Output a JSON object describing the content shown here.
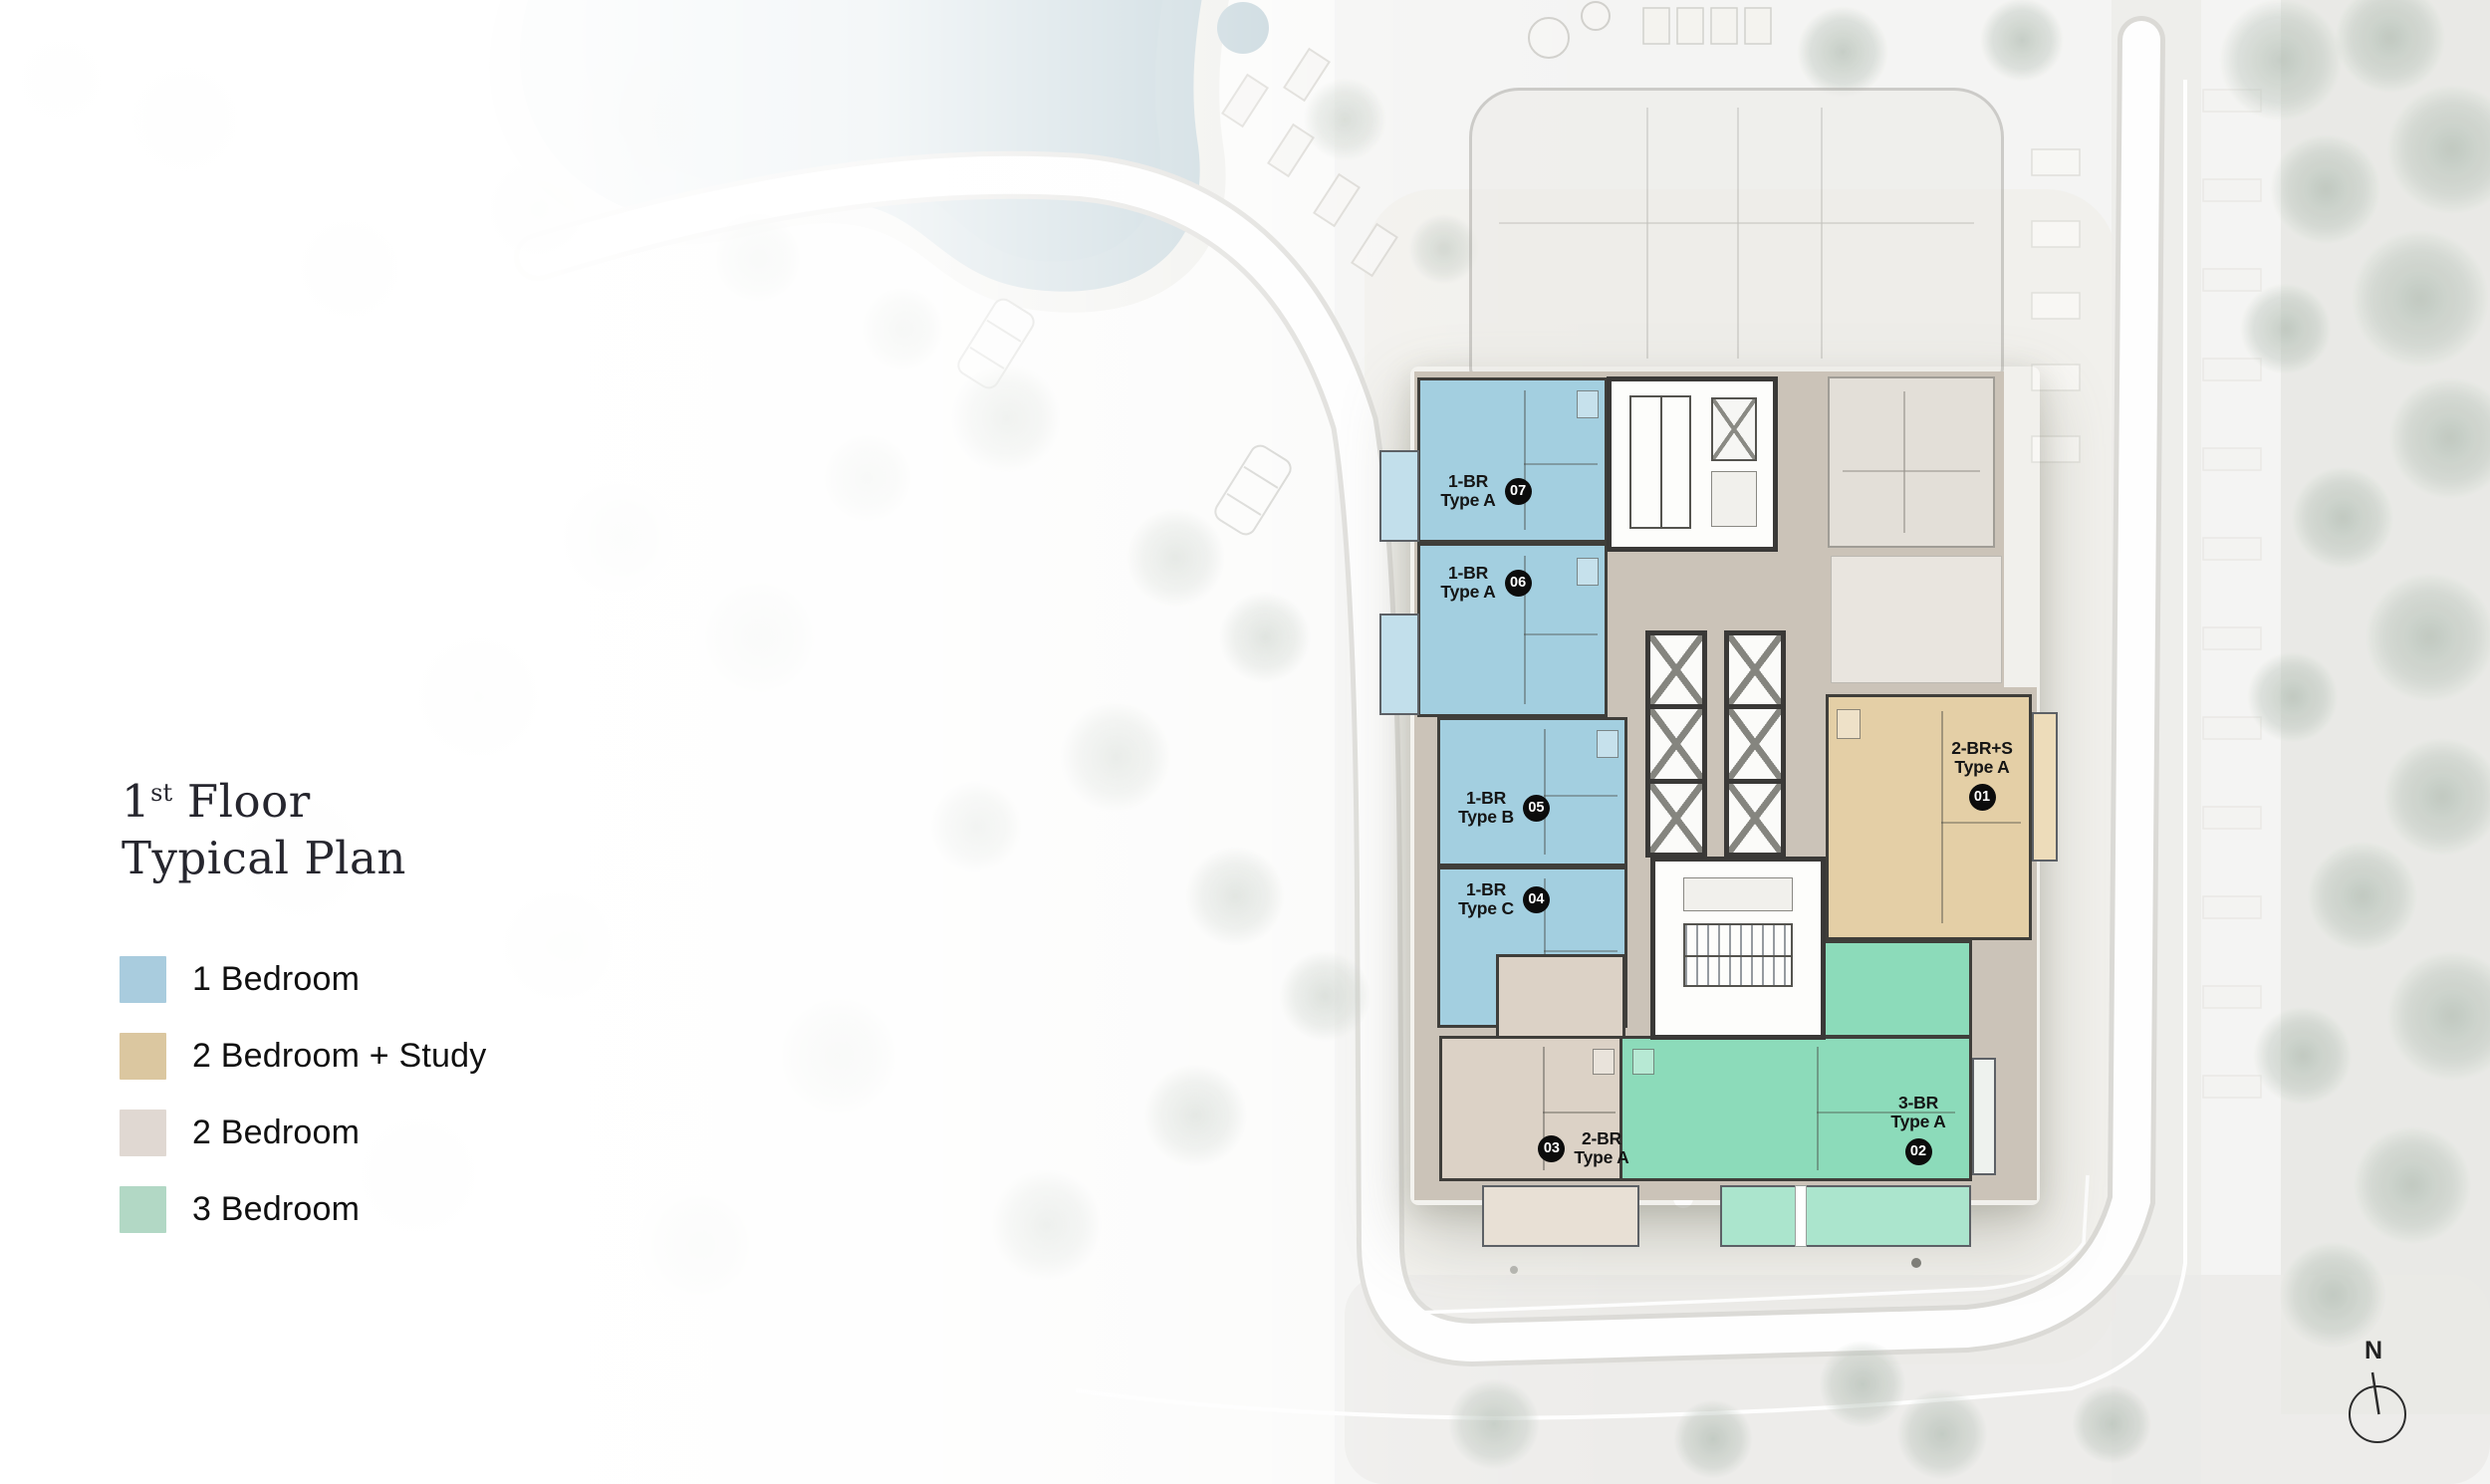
{
  "title": {
    "line1_number": "1",
    "line1_sup": "st",
    "line1_rest": " Floor",
    "line2": "Typical Plan",
    "full": "1st Floor Typical Plan"
  },
  "legend": {
    "items": [
      {
        "label": "1 Bedroom",
        "color": "#a9ccde"
      },
      {
        "label": "2 Bedroom + Study",
        "color": "#dbc7a0"
      },
      {
        "label": "2 Bedroom",
        "color": "#e0d8d2"
      },
      {
        "label": "3 Bedroom",
        "color": "#b2d8c5"
      }
    ]
  },
  "plan": {
    "units": [
      {
        "number": "07",
        "type_line1": "1-BR",
        "type_line2": "Type A",
        "category": "1 Bedroom",
        "color": "#a3cfe0"
      },
      {
        "number": "06",
        "type_line1": "1-BR",
        "type_line2": "Type A",
        "category": "1 Bedroom",
        "color": "#a3cfe0"
      },
      {
        "number": "05",
        "type_line1": "1-BR",
        "type_line2": "Type B",
        "category": "1 Bedroom",
        "color": "#a3cfe0"
      },
      {
        "number": "04",
        "type_line1": "1-BR",
        "type_line2": "Type C",
        "category": "1 Bedroom",
        "color": "#a3cfe0"
      },
      {
        "number": "01",
        "type_line1": "2-BR+S",
        "type_line2": "Type A",
        "category": "2 Bedroom + Study",
        "color": "#e4cfa6"
      },
      {
        "number": "02",
        "type_line1": "3-BR",
        "type_line2": "Type A",
        "category": "3 Bedroom",
        "color": "#8cdbba"
      },
      {
        "number": "03",
        "type_line1": "2-BR",
        "type_line2": "Type A",
        "category": "2 Bedroom",
        "color": "#dcd2c6"
      }
    ]
  },
  "compass": {
    "label": "N"
  }
}
